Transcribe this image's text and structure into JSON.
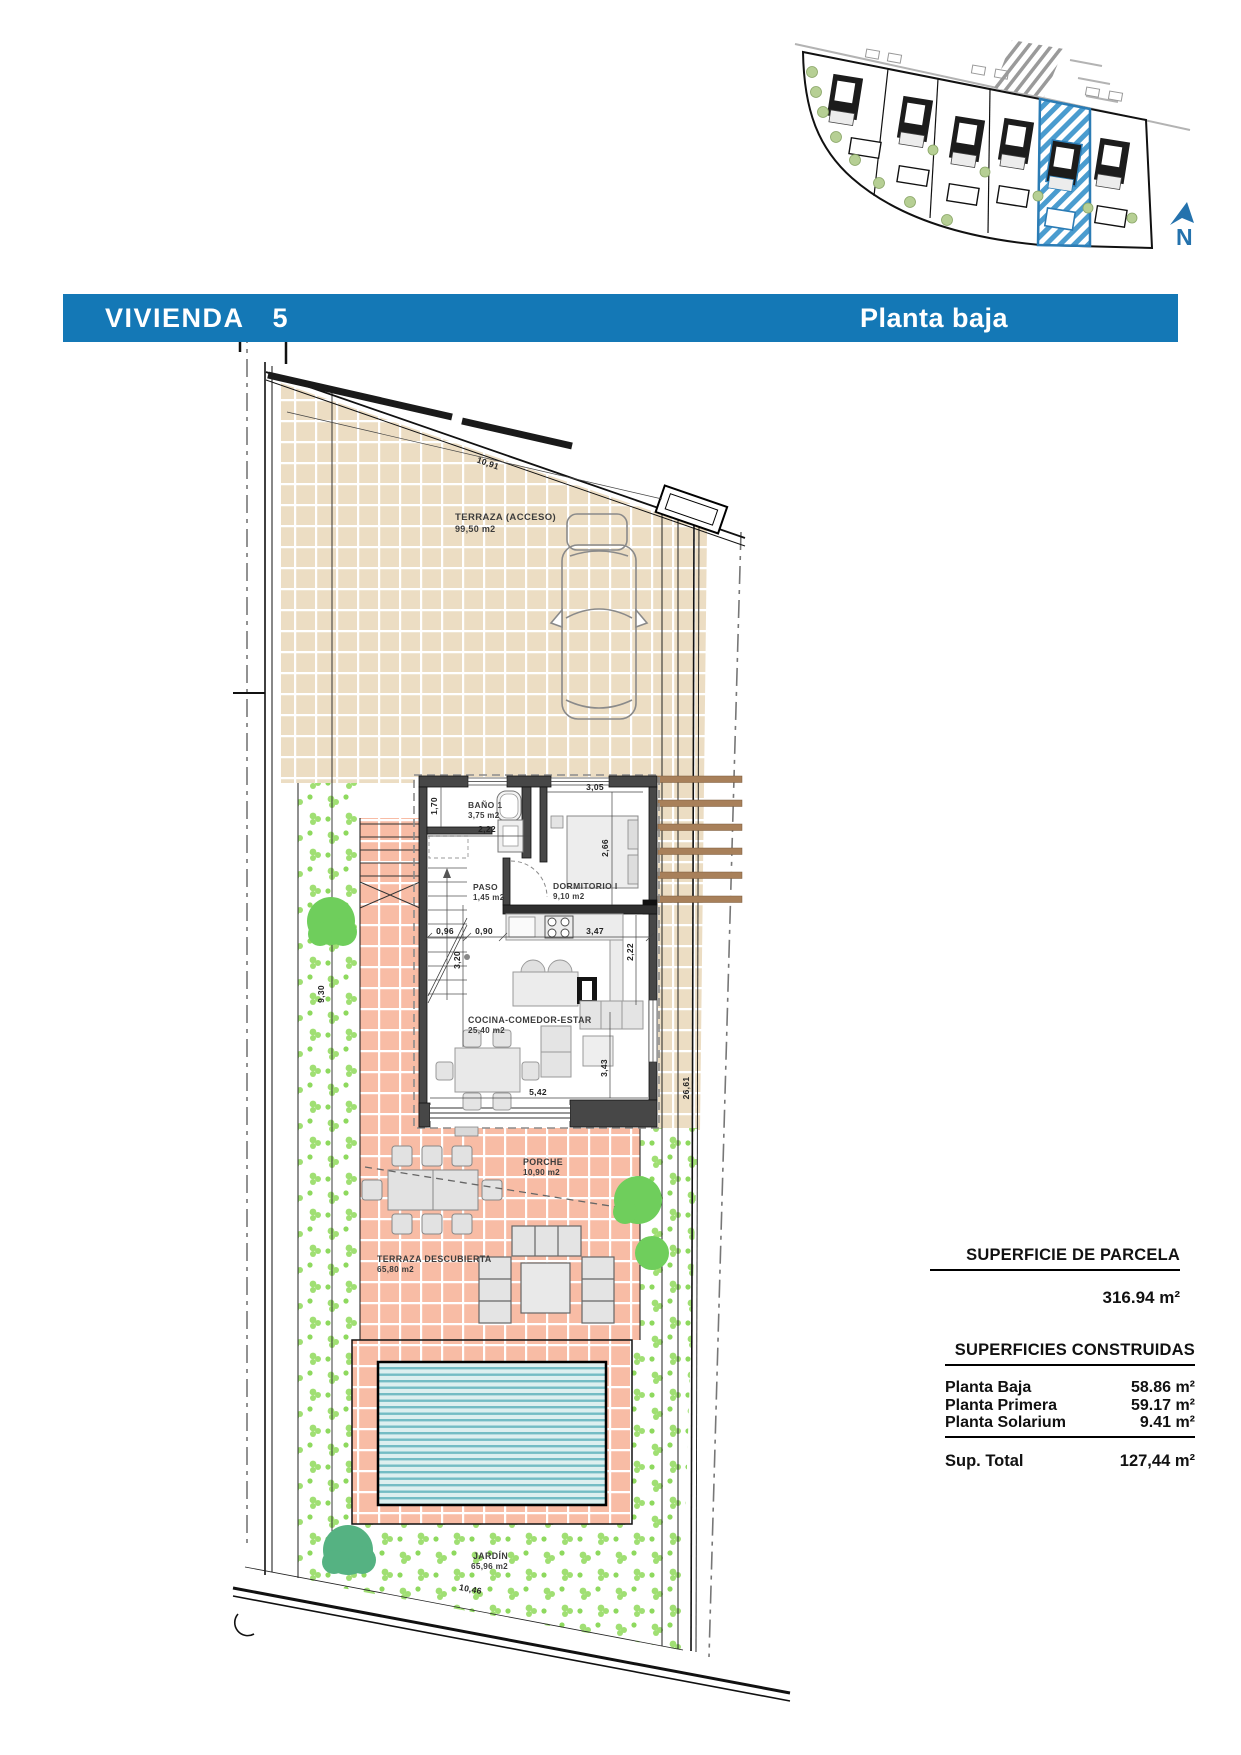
{
  "header": {
    "title": "VIVIENDA",
    "number": "5",
    "floor": "Planta baja"
  },
  "site_plan": {
    "north": "N"
  },
  "rooms": {
    "terraza_acceso": {
      "name": "TERRAZA (ACCESO)",
      "area": "99,50 m2"
    },
    "bano": {
      "name": "BAÑO 1",
      "area": "3,75 m2"
    },
    "dormitorio": {
      "name": "DORMITORIO I",
      "area": "9,10 m2"
    },
    "paso": {
      "name": "PASO",
      "area": "1,45 m2"
    },
    "cocina": {
      "name": "COCINA-COMEDOR-ESTAR",
      "area": "25,40 m2"
    },
    "porche": {
      "name": "PORCHE",
      "area": "10,90 m2"
    },
    "terraza_descubierta": {
      "name": "TERRAZA DESCUBIERTA",
      "area": "65,80 m2"
    },
    "jardin": {
      "name": "JARDÍN",
      "area": "65,96 m2"
    }
  },
  "dimensions": {
    "terraza_frente": "10,91",
    "bano_alto": "1,70",
    "bano_ancho": "2,22",
    "dormitorio_ancho": "3,05",
    "dormitorio_alto": "2,66",
    "escalera_ancho": "0,96",
    "paso_ancho": "0,90",
    "cocina_ancho": "3,47",
    "cocina_alto": "2,22",
    "escalera_largo": "3,20",
    "salon_ancho": "5,42",
    "salon_alto": "3,43",
    "jardin_lateral": "9,30",
    "parcela_fondo": "26,61",
    "parcela_frente_sur": "10,46"
  },
  "summary": {
    "parcela": {
      "heading": "SUPERFICIE DE PARCELA",
      "value": "316.94 m²"
    },
    "construidas": {
      "heading": "SUPERFICIES CONSTRUIDAS",
      "rows": [
        {
          "label": "Planta Baja",
          "value": "58.86 m²"
        },
        {
          "label": "Planta Primera",
          "value": "59.17 m²"
        },
        {
          "label": "Planta Solarium",
          "value": "9.41 m²"
        }
      ],
      "total": {
        "label": "Sup. Total",
        "value": "127,44 m²"
      }
    }
  },
  "colors": {
    "accent_blue": "#1478b6",
    "highlight_blue": "#2b7cb5",
    "tan_tile": "#ecddc3",
    "salmon_tile": "#f8bca5",
    "garden_green": "#a0df73",
    "pool_teal": "#74bcc4",
    "pergola_brown": "#a8805a"
  }
}
